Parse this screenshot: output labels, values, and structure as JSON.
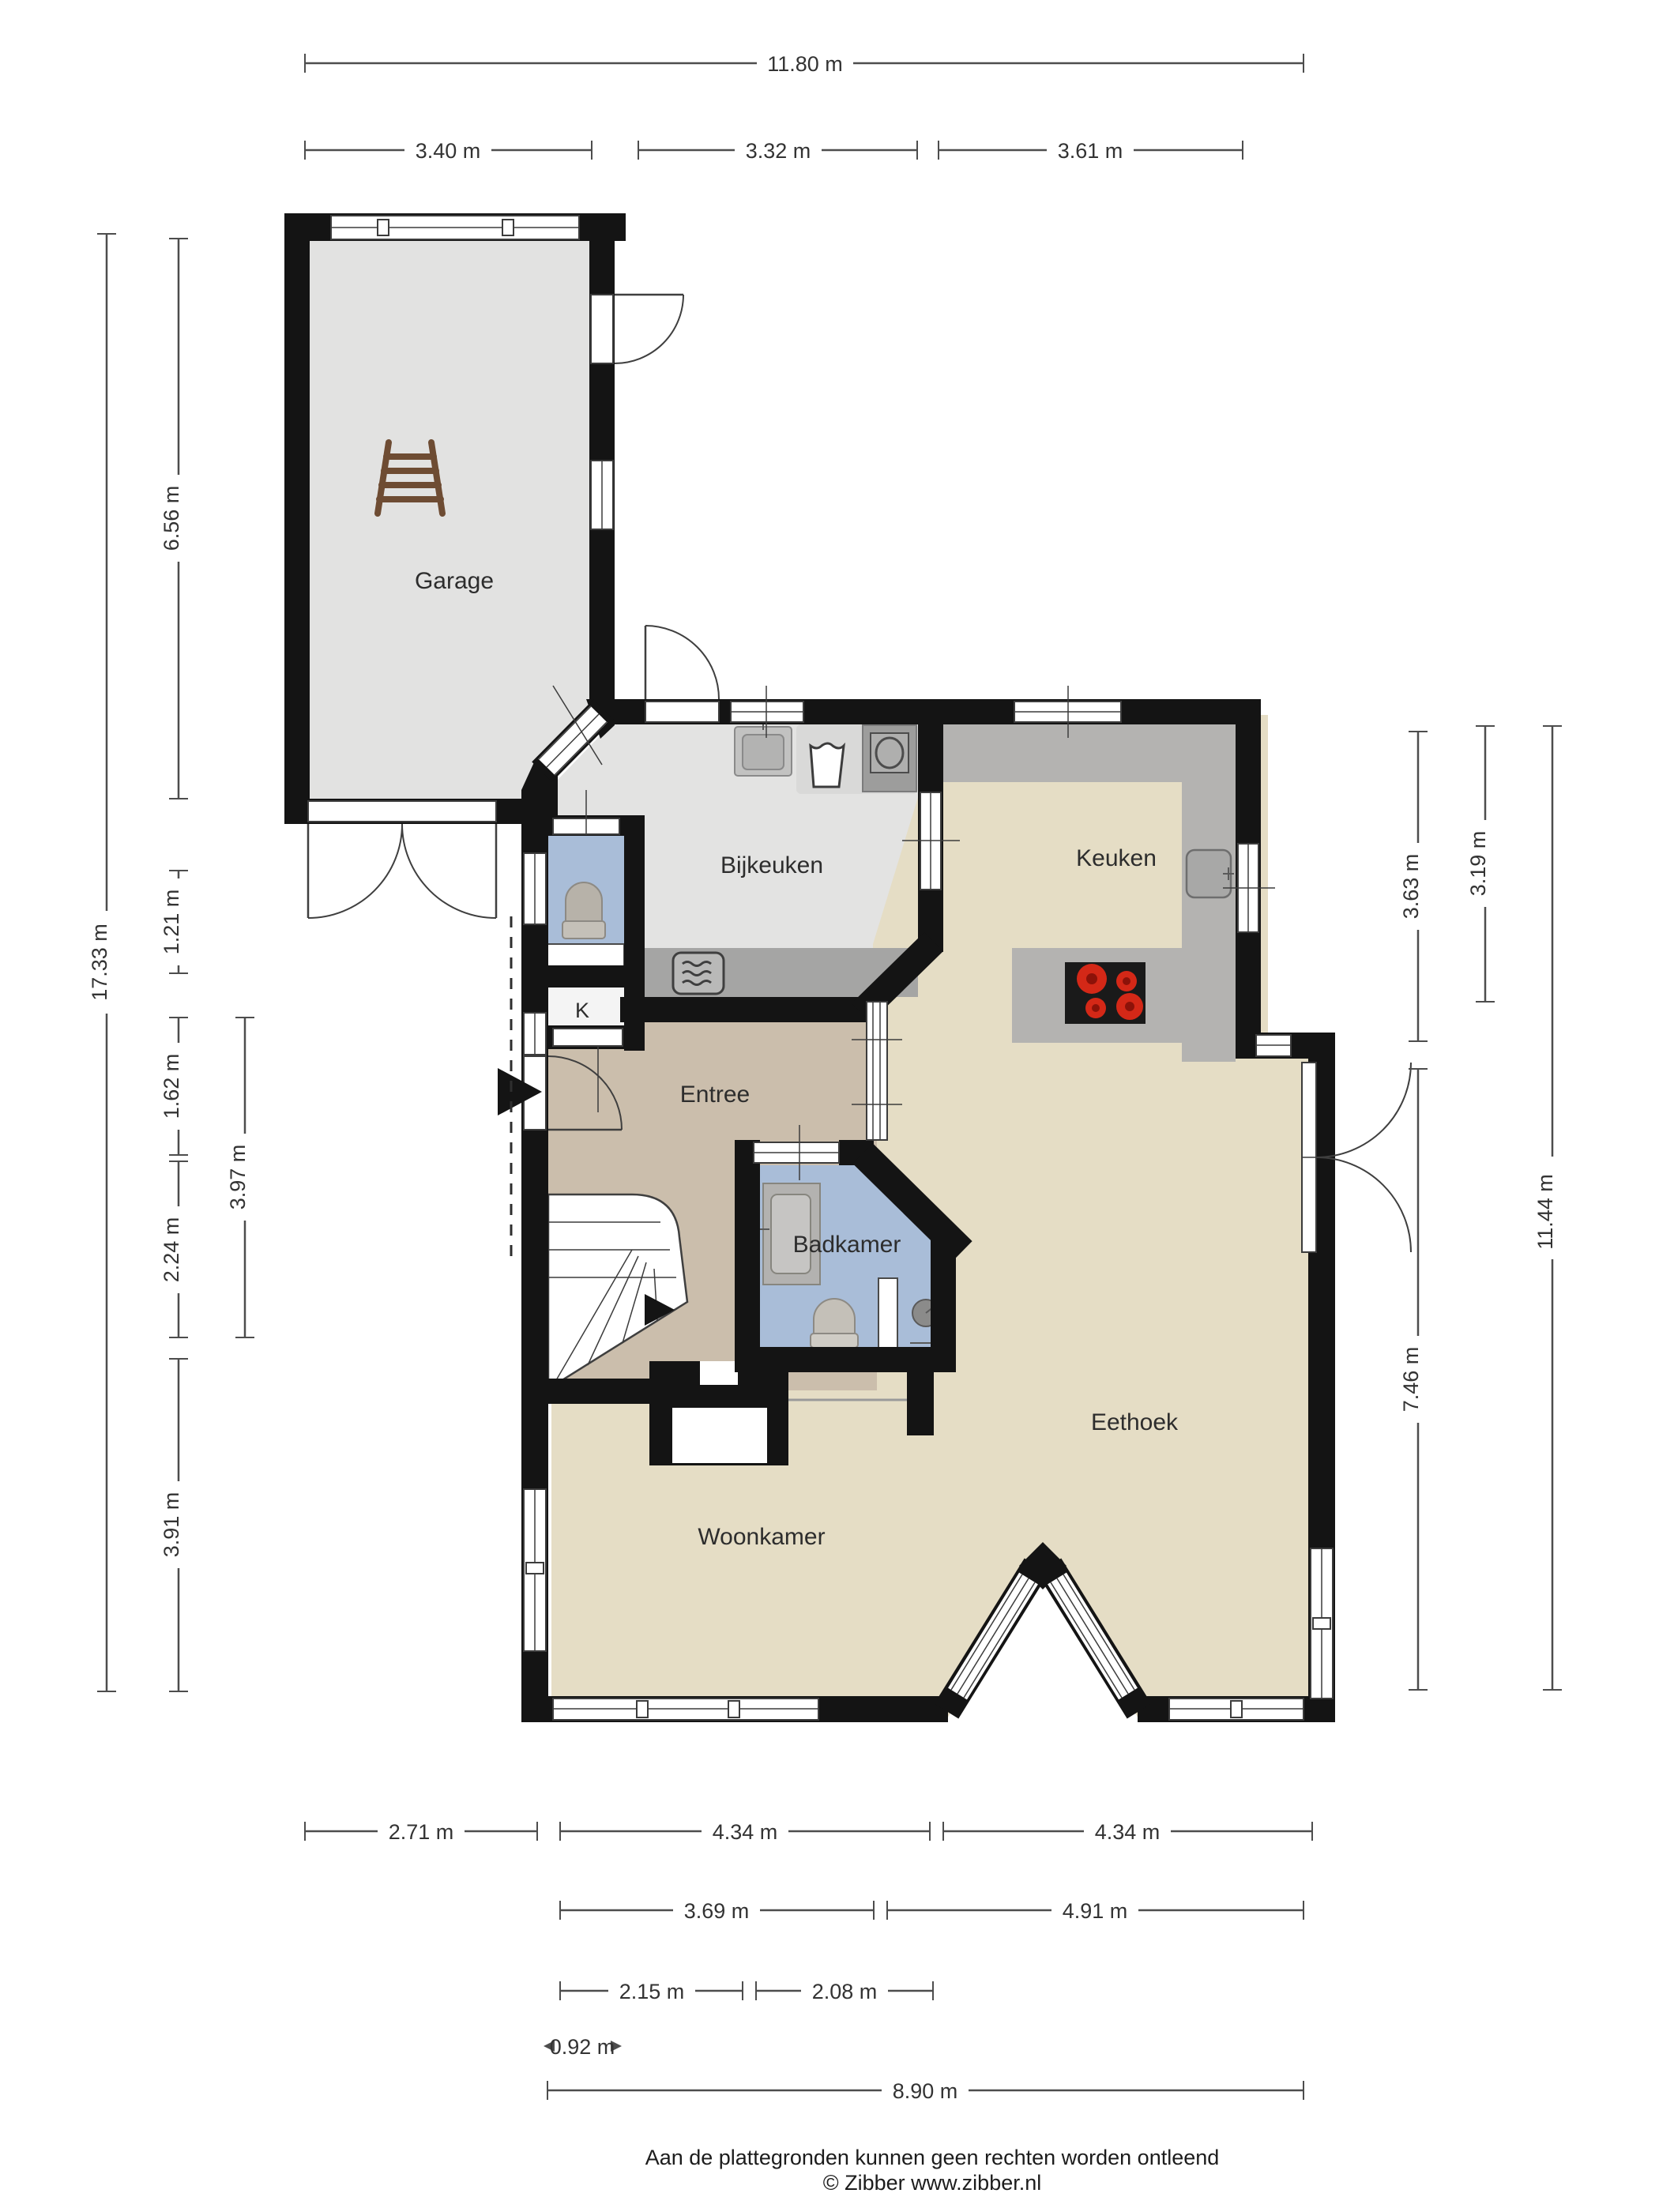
{
  "rooms": {
    "garage": "Garage",
    "bijkeuken": "Bijkeuken",
    "keuken": "Keuken",
    "entree": "Entree",
    "badkamer": "Badkamer",
    "eethoek": "Eethoek",
    "woonkamer": "Woonkamer",
    "closet": "K"
  },
  "dims": {
    "top": [
      "11.80 m",
      "3.40 m",
      "3.32 m",
      "3.61 m"
    ],
    "left": [
      "17.33 m",
      "6.56 m",
      "1.21 m",
      "1.62 m",
      "2.24 m",
      "3.91 m",
      "3.97 m"
    ],
    "right": [
      "3.63 m",
      "7.46 m",
      "3.19 m",
      "11.44 m"
    ],
    "bottom": [
      "2.71 m",
      "4.34 m",
      "4.34 m",
      "3.69 m",
      "4.91 m",
      "2.15 m",
      "2.08 m",
      "0.92 m",
      "8.90 m"
    ]
  },
  "footer": {
    "line1": "Aan de plattegronden kunnen geen rechten worden ontleend",
    "line2": "© Zibber www.zibber.nl"
  },
  "colors": {
    "wall": "#141414",
    "floor_garage": "#e2e2e1",
    "floor_utility": "#e3e3e2",
    "floor_living": "#e5ddc5",
    "floor_entree": "#cbbeac",
    "floor_bath": "#a9bdd8",
    "counter": "#b4b3b1",
    "counter_dark": "#a5a5a4",
    "stove": "#1a1a1a",
    "burner": "#d42817",
    "ladder": "#6e4c33"
  }
}
